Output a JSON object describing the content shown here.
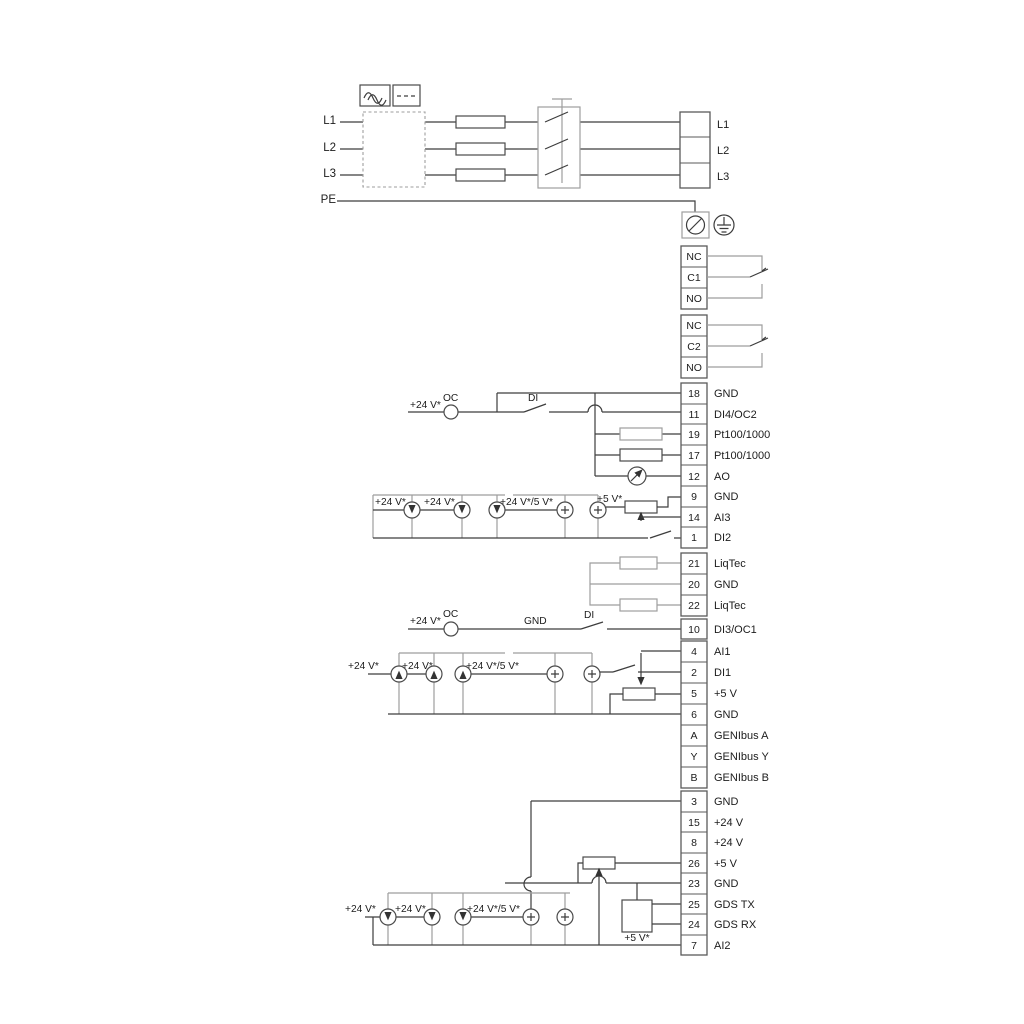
{
  "diagram": {
    "power_input": {
      "lines": [
        "L1",
        "L2",
        "L3",
        "PE"
      ],
      "output_terminals": [
        "L1",
        "L2",
        "L3"
      ]
    },
    "relay1": {
      "terminals": [
        "NC",
        "C1",
        "NO"
      ]
    },
    "relay2": {
      "terminals": [
        "NC",
        "C2",
        "NO"
      ]
    },
    "strip_a": [
      {
        "num": "18",
        "label": "GND"
      },
      {
        "num": "11",
        "label": "DI4/OC2"
      },
      {
        "num": "19",
        "label": "Pt100/1000"
      },
      {
        "num": "17",
        "label": "Pt100/1000"
      },
      {
        "num": "12",
        "label": "AO"
      },
      {
        "num": "9",
        "label": "GND"
      },
      {
        "num": "14",
        "label": "AI3"
      },
      {
        "num": "1",
        "label": "DI2"
      }
    ],
    "strip_b": [
      {
        "num": "21",
        "label": "LiqTec"
      },
      {
        "num": "20",
        "label": "GND"
      },
      {
        "num": "22",
        "label": "LiqTec"
      }
    ],
    "terminal_10": {
      "num": "10",
      "label": "DI3/OC1"
    },
    "strip_c": [
      {
        "num": "4",
        "label": "AI1"
      },
      {
        "num": "2",
        "label": "DI1"
      },
      {
        "num": "5",
        "label": "+5 V"
      },
      {
        "num": "6",
        "label": "GND"
      },
      {
        "num": "A",
        "label": "GENIbus A"
      },
      {
        "num": "Y",
        "label": "GENIbus Y"
      },
      {
        "num": "B",
        "label": "GENIbus B"
      }
    ],
    "strip_d": [
      {
        "num": "3",
        "label": "GND"
      },
      {
        "num": "15",
        "label": "+24 V"
      },
      {
        "num": "8",
        "label": "+24 V"
      },
      {
        "num": "26",
        "label": "+5 V"
      },
      {
        "num": "23",
        "label": "GND"
      },
      {
        "num": "25",
        "label": "GDS TX"
      },
      {
        "num": "24",
        "label": "GDS RX"
      },
      {
        "num": "7",
        "label": "AI2"
      }
    ],
    "di4_circuit": {
      "supply": "+24 V*",
      "oc": "OC",
      "di": "DI"
    },
    "di3_circuit": {
      "supply": "+24 V*",
      "oc": "OC",
      "gnd": "GND",
      "di": "DI"
    },
    "ai3_group": {
      "l1": "+24 V*",
      "l2": "+24 V*",
      "l3": "+24 V*/5 V*",
      "l4": "+5 V*"
    },
    "ai1_group": {
      "l1": "+24 V*",
      "l2": "+24 V*",
      "l3": "+24 V*/5 V*"
    },
    "ai2_group": {
      "l1": "+24 V*",
      "l2": "+24 V*",
      "l3": "+24 V*/5 V*",
      "l4": "+5 V*"
    },
    "colors": {
      "wire_dark": "#3d3d3d",
      "wire_gray": "#9e9e9e",
      "text": "#1c1c1c",
      "background": "#ffffff"
    }
  }
}
